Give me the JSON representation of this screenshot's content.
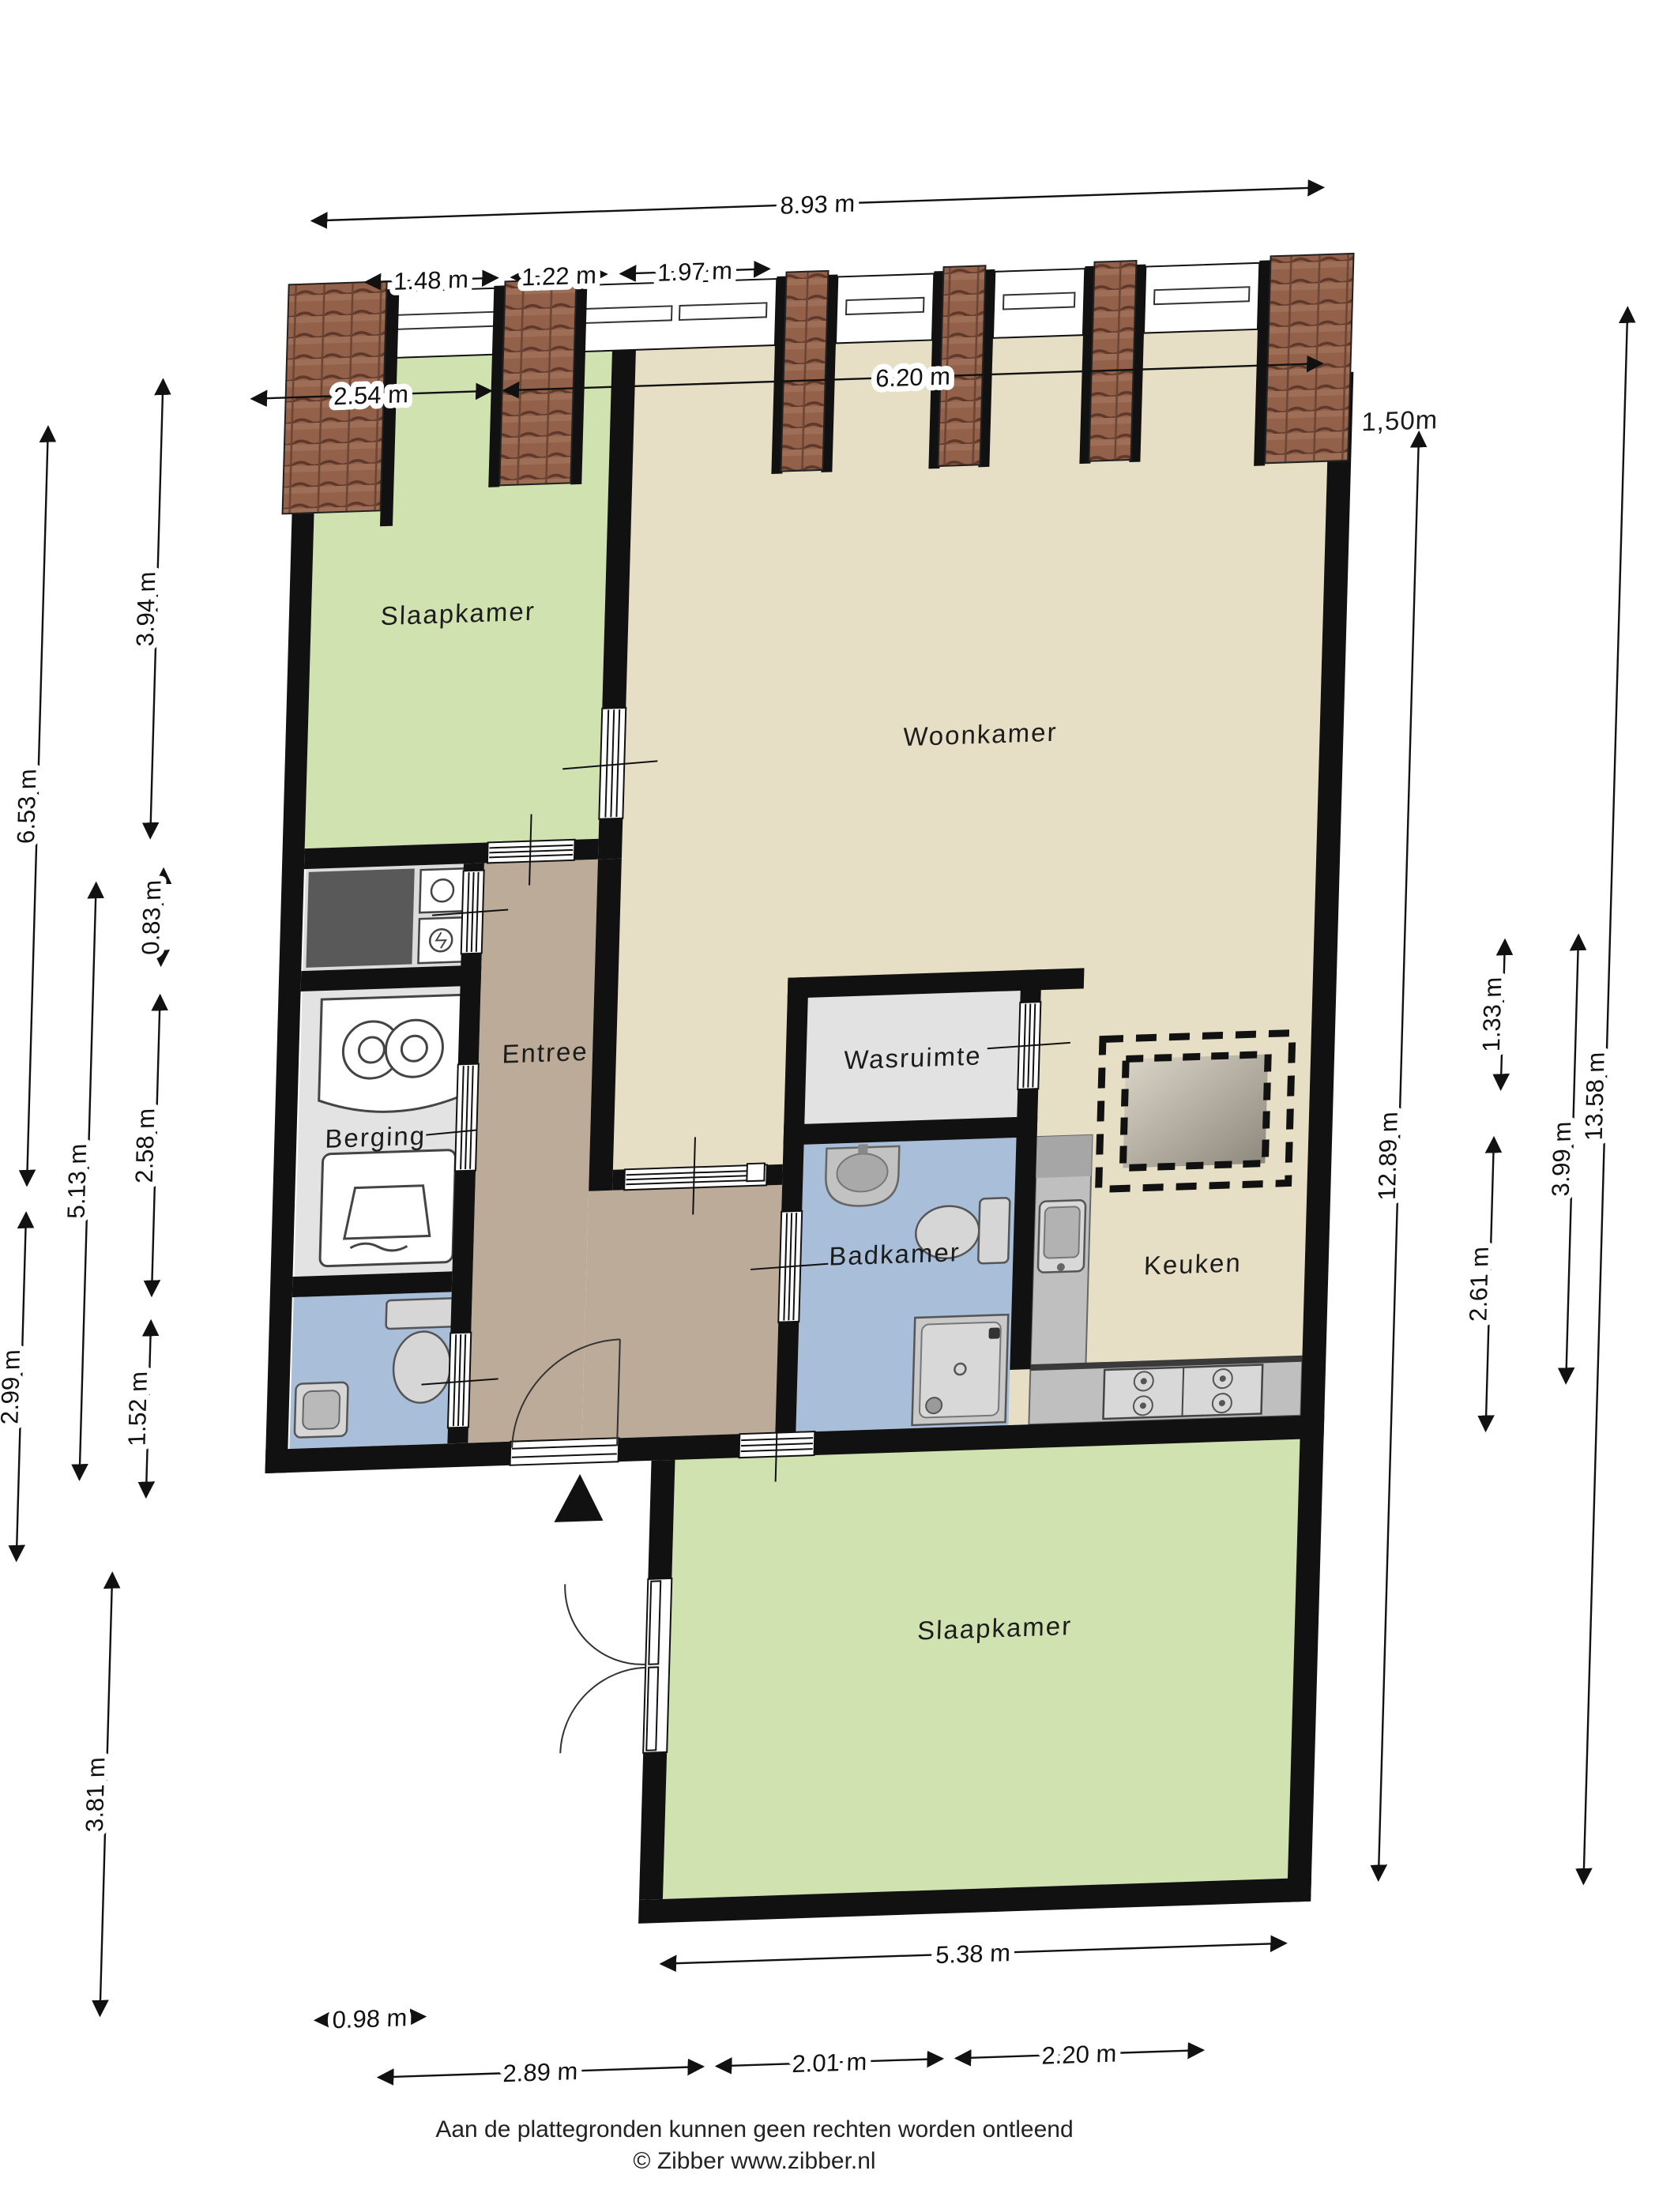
{
  "rooms": {
    "bedroom_top": "Slaapkamer",
    "living": "Woonkamer",
    "laundry": "Wasruimte",
    "storage": "Berging",
    "hall": "Entree",
    "bathroom": "Badkamer",
    "kitchen": "Keuken",
    "bedroom_bottom": "Slaapkamer"
  },
  "dimensions": {
    "top_total": "8.93 m",
    "top_sub1": "1.48 m",
    "top_sub2": "1.22 m",
    "top_sub3": "1.97 m",
    "top_left": "2.54 m",
    "top_right": "6.20 m",
    "left_total": "6.53 m",
    "left_bedroom": "3.94 m",
    "left_tech": "0.83 m",
    "left_mid": "5.13 m",
    "left_storage": "2.58 m",
    "left_lower": "2.99 m",
    "left_wc": "1.52 m",
    "left_bedroom2": "3.81 m",
    "right_height_note": "1,50m",
    "right_main": "12.89 m",
    "right_sub1": "1.33 m",
    "right_sub2": "2.61 m",
    "right_sub3": "3.99 m",
    "right_total": "13.58 m",
    "bottom_bedroom": "5.38 m",
    "bottom_porch": "0.98 m",
    "bottom_sub1": "2.89 m",
    "bottom_sub2": "2.01 m",
    "bottom_sub3": "2.20 m"
  },
  "footer": {
    "disclaimer": "Aan de plattegronden kunnen geen rechten worden ontleend",
    "credit": "© Zibber www.zibber.nl"
  },
  "colors": {
    "wall": "#111111",
    "living_floor": "#e7dfc5",
    "hall_floor": "#bcab99",
    "bedroom_floor": "#cfe2b0",
    "utility_floor": "#e3e3e3",
    "wet_floor": "#a9bed9",
    "counter": "#bfbfbf",
    "roof_tiles": "#93604a",
    "dark_closet": "#595959"
  }
}
